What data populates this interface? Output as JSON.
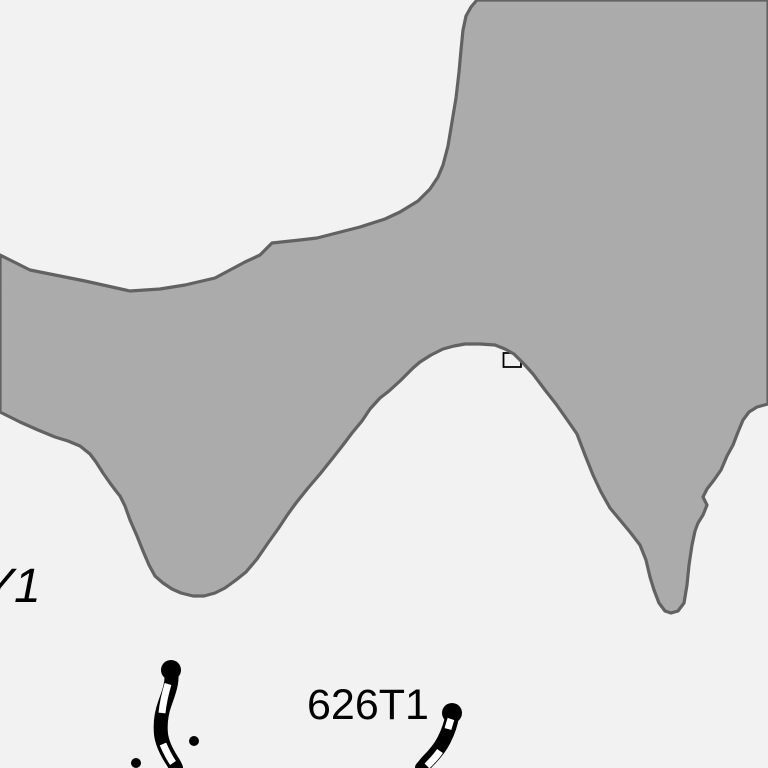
{
  "map": {
    "background_color": "#f2f2f2",
    "labels": {
      "trail_label": "626T1",
      "partial_label": "Y1"
    },
    "area": {
      "name": "shaded-terrain-area",
      "fill": "#ababab",
      "stroke": "#626262",
      "stroke_width": 3.2,
      "points": "0,255 30,270 85,281 130,291 160,289 185,285 215,278 245,262 260,255 272,243 300,240 317,238 360,227 385,219 400,212 418,201 430,189 438,177 443,165 448,146 452,122 456,98 459,72 461,50 463,30 466,16 471,7 477,0 768,0 768,404 757,407 749,412 743,420 738,432 733,445 727,456 721,470 714,480 707,489 703,497 707,505 703,515 698,523 695,531 692,545 689,565 687,585 684,603 678,611 671,613 665,611 659,603 654,590 650,577 646,560 640,545 630,532 620,520 610,508 601,492 593,475 585,455 577,434 568,421 556,404 545,390 533,374 524,364 514,354 505,349 495,345 480,344 465,344 454,346 443,349 431,355 420,362 413,368 400,381 389,391 380,398 370,409 362,421 352,433 343,445 332,459 320,474 308,488 296,503 288,514 278,529 268,543 257,559 246,572 236,580 225,588 215,593 204,596 193,596 181,593 172,589 163,583 155,576 149,565 143,551 137,536 130,520 125,506 120,496 116,491 110,483 103,473 96,462 90,454 80,446 68,441 55,437 38,430 20,422 0,412"
    },
    "building": {
      "name": "building-outline",
      "path": "M512,353 L503.5,353 L503.5,367 L521,367 L521,361",
      "stroke": "#000000",
      "stroke_width": 1.8
    },
    "trail_style": {
      "color": "#000000",
      "dash_color": "#ffffff",
      "outer_width": 14,
      "dash_width": 7,
      "cap_radius": 10
    },
    "trails": [
      {
        "name": "dashed-trail-left",
        "cap": {
          "cx": 171,
          "cy": 670
        },
        "path": "M171,672 C173,681 169,692 165,703 C161,714 160,724 161,734 C162,743 166,751 171,759 C173,762 175,765 176,768",
        "dashes": [
          "M168,684 C165,694 163,703 162,713",
          "M163,744 C166,751 169,757 173,763"
        ]
      },
      {
        "name": "dashed-trail-right",
        "cap": {
          "cx": 452,
          "cy": 713
        },
        "path": "M452,716 C451,724 448,732 444,740 C440,748 434,755 428,761 C426,763 424,766 422,768",
        "dashes": [
          "M451,719 C450,722 449,725 448,729",
          "M440,751 C436,757 432,761 427,766"
        ]
      }
    ],
    "dots": [
      {
        "name": "waypoint-dot",
        "cx": 194,
        "cy": 741,
        "r": 5,
        "color": "#000000"
      },
      {
        "name": "waypoint-dot",
        "cx": 136,
        "cy": 763,
        "r": 5,
        "color": "#000000"
      }
    ]
  }
}
